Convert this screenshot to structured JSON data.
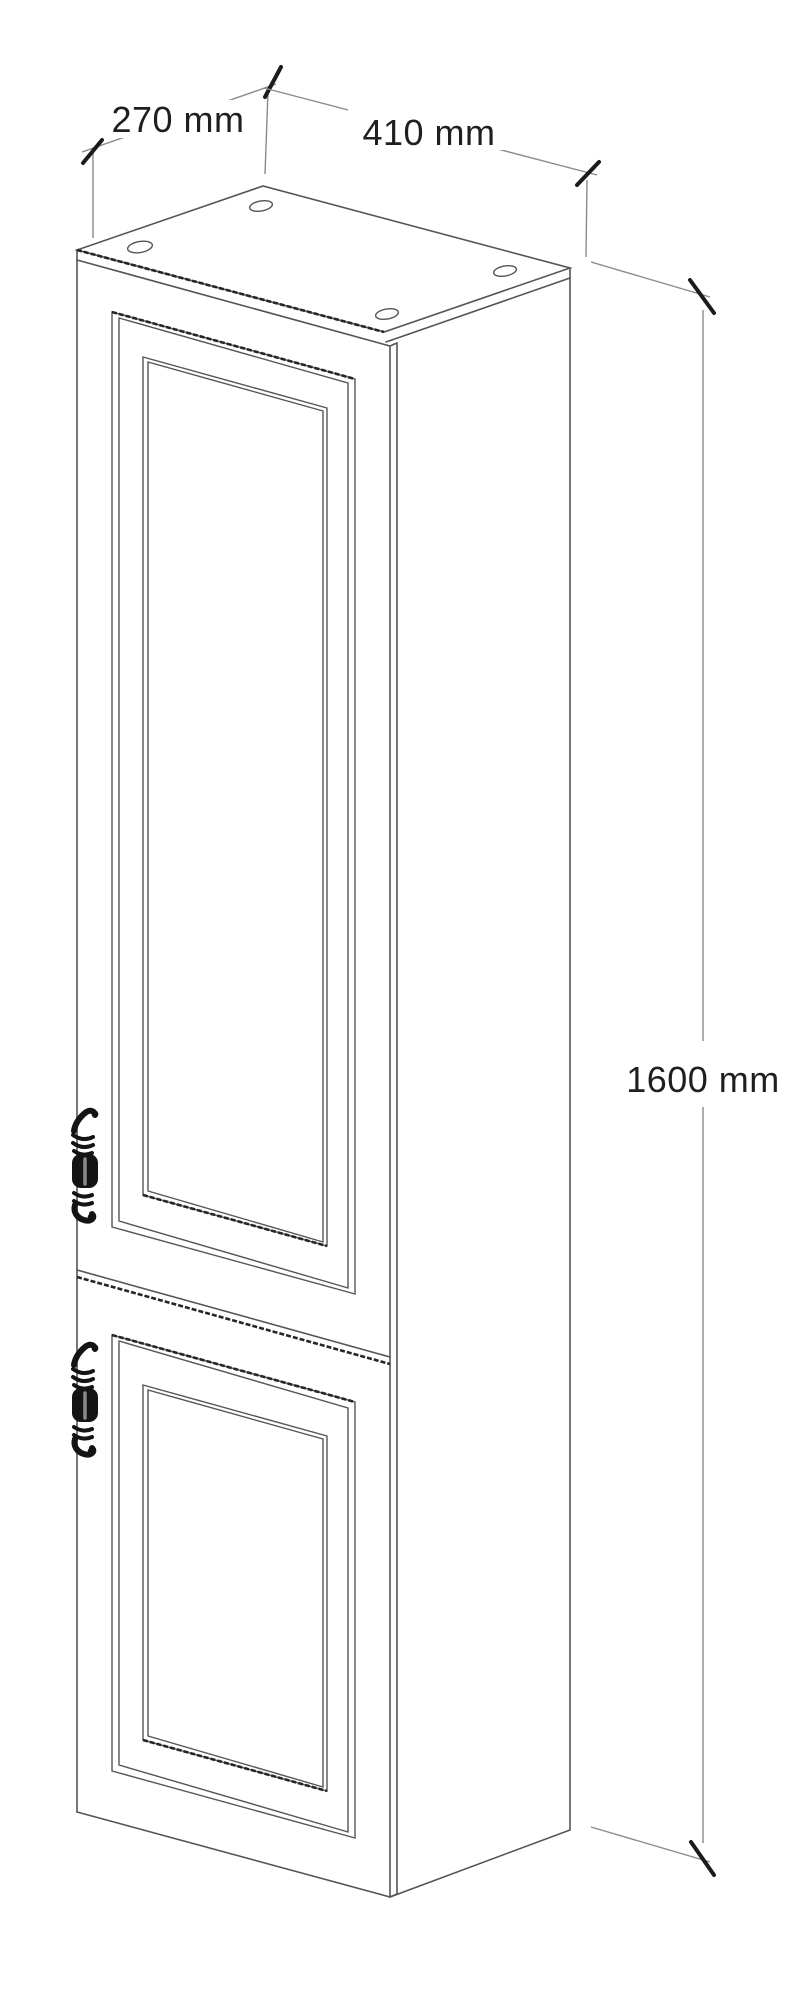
{
  "drawing": {
    "kind": "isometric line drawing of a tall two-door cabinet",
    "dimensions": {
      "depth": {
        "label": "270 mm",
        "value": 270,
        "unit": "mm"
      },
      "width": {
        "label": "410 mm",
        "value": 410,
        "unit": "mm"
      },
      "height": {
        "label": "1600 mm",
        "value": 1600,
        "unit": "mm"
      }
    },
    "colors": {
      "background": "#ffffff",
      "line": "#555555",
      "shadow_edge": "#262626",
      "dimension_line": "#8a8a8a",
      "tick": "#1b1b1b",
      "text": "#1f1f1f",
      "handle": "#141414"
    }
  }
}
